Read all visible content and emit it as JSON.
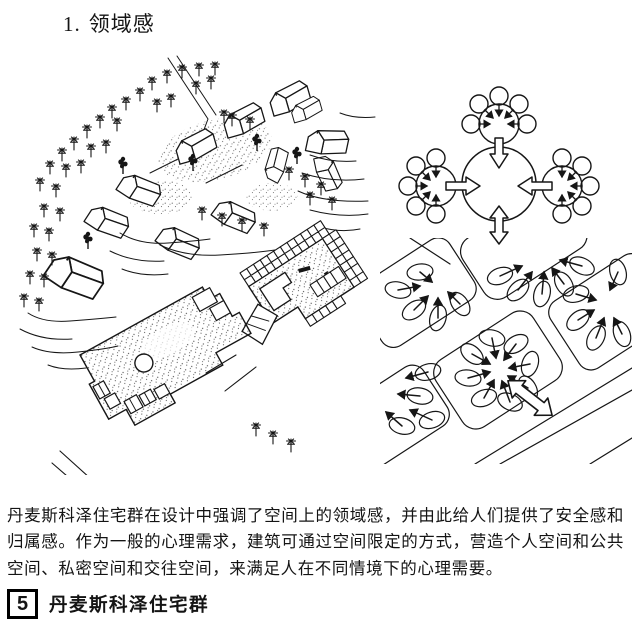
{
  "page": {
    "section_number": "1.",
    "section_title": "领域感",
    "body_text": "丹麦斯科泽住宅群在设计中强调了空间上的领域感，并由此给人们提供了安全感和归属感。作为一般的心理需求，建筑可通过空间限定的方式，营造个人空间和公共空间、私密空间和交往空间，来满足人在不同情境下的心理需要。",
    "caption": {
      "number": "5",
      "title": "丹麦斯科泽住宅群"
    }
  },
  "figures": {
    "main_drawing": "housing-site-axonometric-and-plan-drawing",
    "top_right_diagram": "territory-cluster-circles-diagram",
    "bottom_right_diagram": "street-blocks-territory-diagram"
  },
  "colors": {
    "ink": "#161616",
    "paper": "#ffffff"
  }
}
